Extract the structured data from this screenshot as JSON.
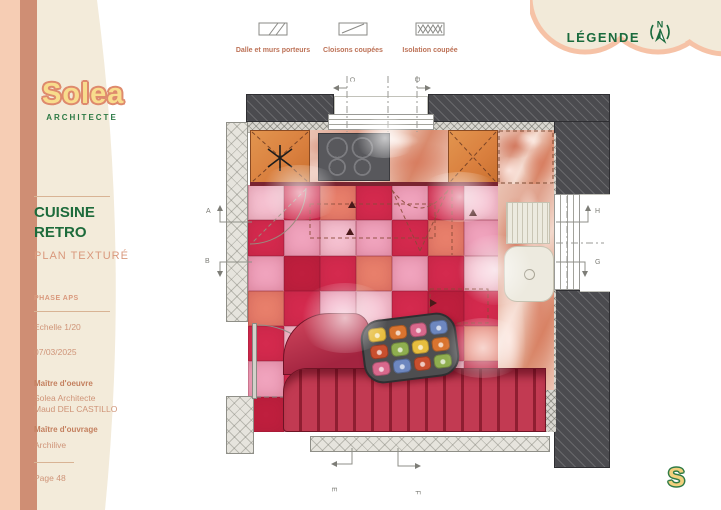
{
  "brand": {
    "name": "Solea",
    "subtitle": "ARCHITECTE",
    "mark": "S"
  },
  "legend": {
    "title": "LÉGENDE",
    "compass_letter": "N",
    "items": [
      {
        "label": "Dalle et murs porteurs"
      },
      {
        "label": "Cloisons coupées"
      },
      {
        "label": "Isolation coupée"
      }
    ]
  },
  "titleblock": {
    "project_line1": "CUISINE",
    "project_line2": "RETRO",
    "plan_type": "PLAN TEXTURÉ",
    "phase": "PHASE APS",
    "scale": "Echelle 1/20",
    "date": "07/03/2025",
    "moe_label": "Maître d'oeuvre",
    "moe_name": "Solea Architecte",
    "moe_person": "Maud DEL CASTILLO",
    "moa_label": "Maître d'ouvrage",
    "moa_name": "Archilive",
    "page_label": "Page 48"
  },
  "plan": {
    "section_markers": {
      "left_top": "A",
      "left_bottom": "B",
      "top_left": "C",
      "top_right": "D",
      "bottom_left": "E",
      "bottom_right": "F",
      "right_top": "H",
      "right_bottom": "G"
    },
    "floor": {
      "palette": [
        "#d42a4e",
        "#f0a3bd",
        "#e87f6b",
        "#f5c0d0",
        "#bf1f3e"
      ],
      "tiles": [
        [
          3,
          0,
          2,
          0,
          1,
          0,
          3
        ],
        [
          0,
          1,
          3,
          1,
          0,
          2,
          1
        ],
        [
          1,
          4,
          0,
          2,
          1,
          0,
          3
        ],
        [
          2,
          0,
          1,
          3,
          0,
          4,
          0
        ],
        [
          0,
          3,
          4,
          1,
          2,
          0,
          2
        ],
        [
          1,
          0,
          2,
          0,
          1,
          3,
          4
        ],
        [
          4,
          1,
          0,
          2,
          0,
          1,
          0
        ]
      ]
    },
    "table_palette": [
      "#e7bd3e",
      "#d9742f",
      "#d9688c",
      "#6d87bf",
      "#c94f2e",
      "#8fae4f"
    ],
    "colors": {
      "wall_dark": "#4b4b4f",
      "wall_light": "#e6e4dd",
      "cabinet_orange": "#dd8a4c",
      "banquette_red": "#b02a42",
      "marble_base": "#eec4b6",
      "accent_green": "#1a6b3d",
      "accent_salmon": "#d9987c"
    }
  }
}
